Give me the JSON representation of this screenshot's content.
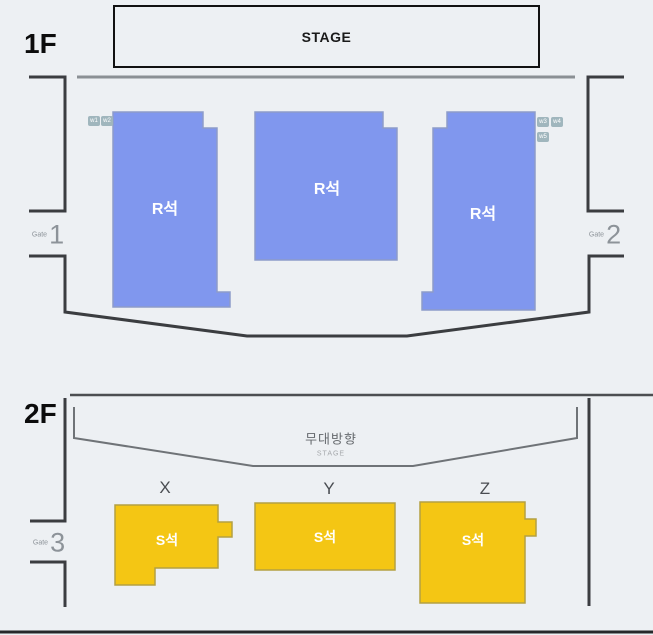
{
  "colors": {
    "bg": "#edf0f3",
    "seat-r": "#8097ee",
    "seat-r-border": "#8d9cc9",
    "seat-s": "#f4c614",
    "seat-s-border": "#b3a042",
    "wall": "#3b3d40",
    "badge-bg": "#a0b6bd",
    "text-gray": "#8d9399"
  },
  "floor1": {
    "label": "1F",
    "stage": {
      "label": "STAGE"
    },
    "sections": [
      {
        "id": "r-left",
        "label": "R석"
      },
      {
        "id": "r-center",
        "label": "R석"
      },
      {
        "id": "r-right",
        "label": "R석"
      }
    ],
    "wheelchair_badges": [
      "w1",
      "w2",
      "w3",
      "w4",
      "w5"
    ],
    "gates": [
      {
        "word": "Gate",
        "number": "1"
      },
      {
        "word": "Gate",
        "number": "2"
      }
    ]
  },
  "floor2": {
    "label": "2F",
    "stage_direction": {
      "korean": "무대방향",
      "english": "STAGE"
    },
    "row_labels": [
      "X",
      "Y",
      "Z"
    ],
    "sections": [
      {
        "id": "s-x",
        "label": "S석"
      },
      {
        "id": "s-y",
        "label": "S석"
      },
      {
        "id": "s-z",
        "label": "S석"
      }
    ],
    "gate": {
      "word": "Gate",
      "number": "3"
    }
  }
}
